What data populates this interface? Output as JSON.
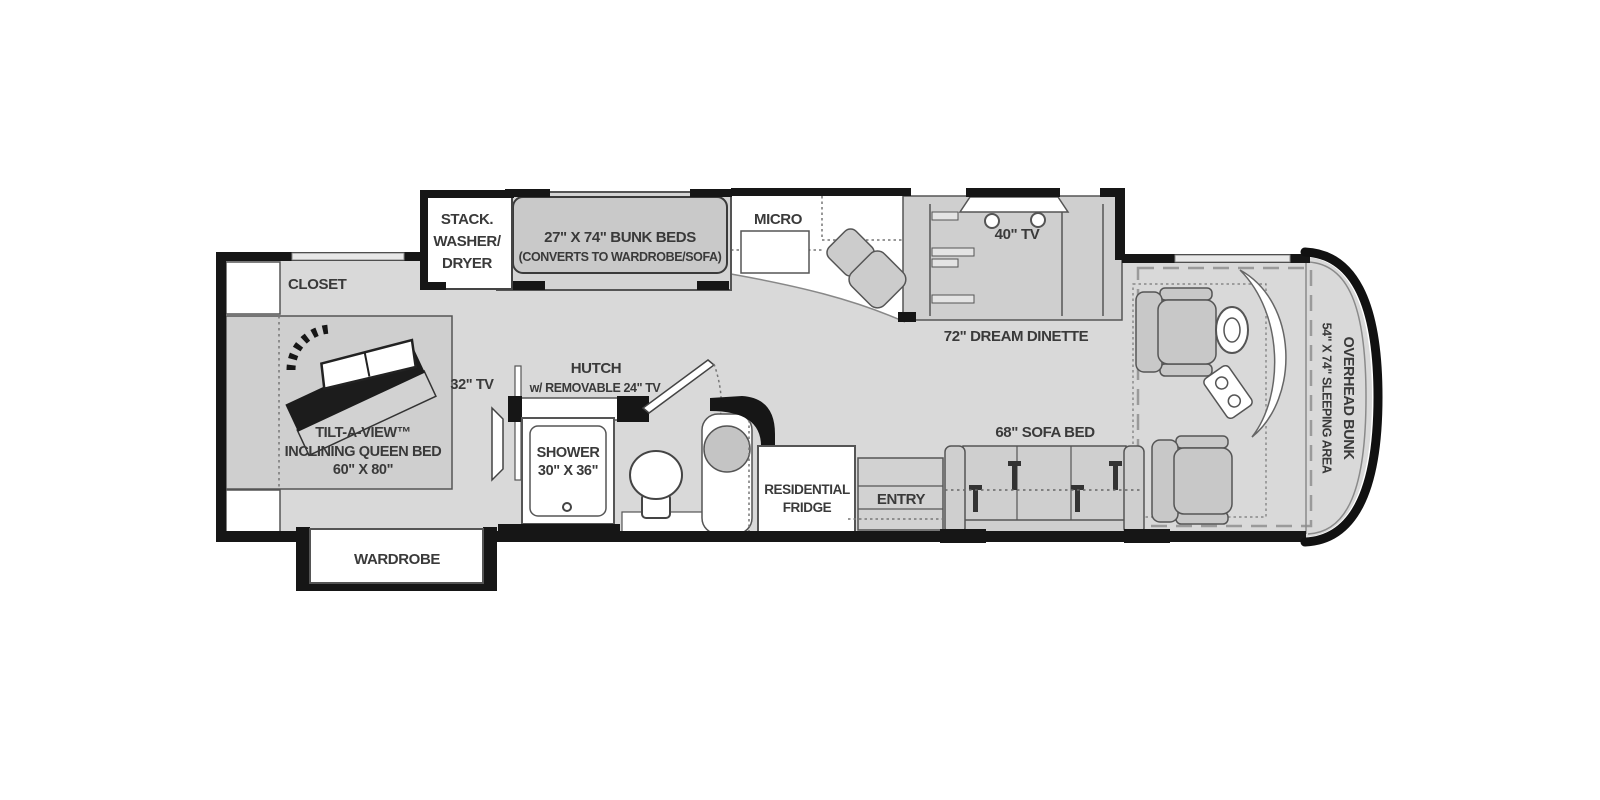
{
  "title": "RV floor plan",
  "colors": {
    "wall": "#161616",
    "floor": "#d9d9d9",
    "slide_floor": "#cfcfcf",
    "furniture_gray": "#c9c9c9",
    "white": "#ffffff",
    "outline": "#4a4a4a",
    "text": "#3a3a3a"
  },
  "rooms": {
    "washer_dryer": {
      "line1": "STACK.",
      "line2": "WASHER/",
      "line3": "DRYER"
    },
    "bunk_beds": {
      "line1": "27\" X 74\" BUNK BEDS",
      "line2": "(CONVERTS TO WARDROBE/SOFA)"
    },
    "micro": {
      "label": "MICRO"
    },
    "tv_40": {
      "label": "40\" TV"
    },
    "dinette": {
      "label": "72\" DREAM DINETTE"
    },
    "closet": {
      "label": "CLOSET"
    },
    "queen_bed": {
      "line1": "TILT-A-VIEW™",
      "line2": "INCLINING QUEEN BED",
      "line3": "60\" X 80\""
    },
    "tv_32": {
      "label": "32\" TV"
    },
    "hutch": {
      "line1": "HUTCH",
      "line2": "w/ REMOVABLE 24\" TV"
    },
    "shower": {
      "line1": "SHOWER",
      "line2": "30\" X 36\""
    },
    "fridge": {
      "line1": "RESIDENTIAL",
      "line2": "FRIDGE"
    },
    "entry": {
      "label": "ENTRY"
    },
    "sofa_bed": {
      "label": "68\" SOFA BED"
    },
    "wardrobe": {
      "label": "WARDROBE"
    },
    "overhead_bunk": {
      "line1": "OVERHEAD BUNK",
      "line2": "54\" X 74\" SLEEPING AREA"
    }
  }
}
